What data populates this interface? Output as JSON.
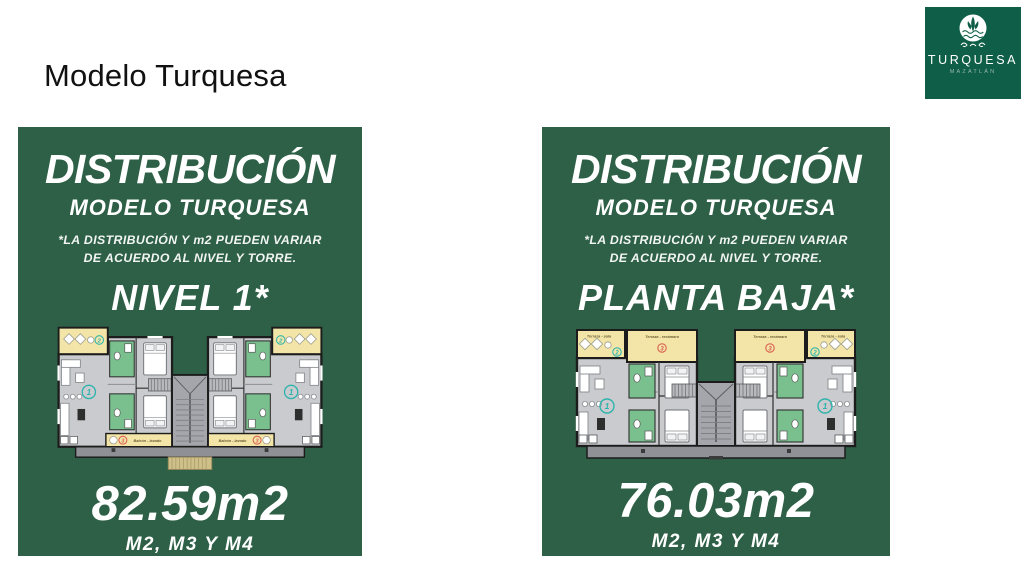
{
  "slide": {
    "title": "Modelo Turquesa"
  },
  "logo": {
    "brand": "TURQUESA",
    "location": "MAZATLÁN",
    "bg_color": "#0f5e47"
  },
  "colors": {
    "card_green": "#2d6046",
    "floor_gray": "#c9cbce",
    "terrace_yellow": "#f3e5a7",
    "bathroom_green": "#79c08e",
    "stair_gray": "#a4a6ab",
    "base_gray": "#8e9095",
    "steps_tan": "#cfc089",
    "accent_teal": "#2fb3ad",
    "accent_red": "#d95f52",
    "wall_black": "#1c1c1c"
  },
  "cards": [
    {
      "heading": "DISTRIBUCIÓN",
      "subheading": "MODELO TURQUESA",
      "disclaimer_line1": "*LA DISTRIBUCIÓN Y m2 PUEDEN VARIAR",
      "disclaimer_line2": "DE ACUERDO AL NIVEL Y TORRE.",
      "level": "NIVEL 1*",
      "area": "82.59m2",
      "models": "M2, M3 Y M4",
      "plan": {
        "unit_number": "1",
        "terrace_sala_number": "2",
        "balcony_number": "3",
        "balcony_label": "Balcón - lavado"
      }
    },
    {
      "heading": "DISTRIBUCIÓN",
      "subheading": "MODELO TURQUESA",
      "disclaimer_line1": "*LA DISTRIBUCIÓN Y m2 PUEDEN VARIAR",
      "disclaimer_line2": "DE ACUERDO AL NIVEL Y TORRE.",
      "level": "PLANTA BAJA*",
      "area": "76.03m2",
      "models": "M2, M3 Y M4",
      "plan": {
        "unit_number": "1",
        "terrace_sala_number": "2",
        "terrace_rec_number": "3",
        "terrace_sala_label": "Terraza - sala",
        "terrace_rec_label": "Terraza - recámara"
      }
    }
  ]
}
